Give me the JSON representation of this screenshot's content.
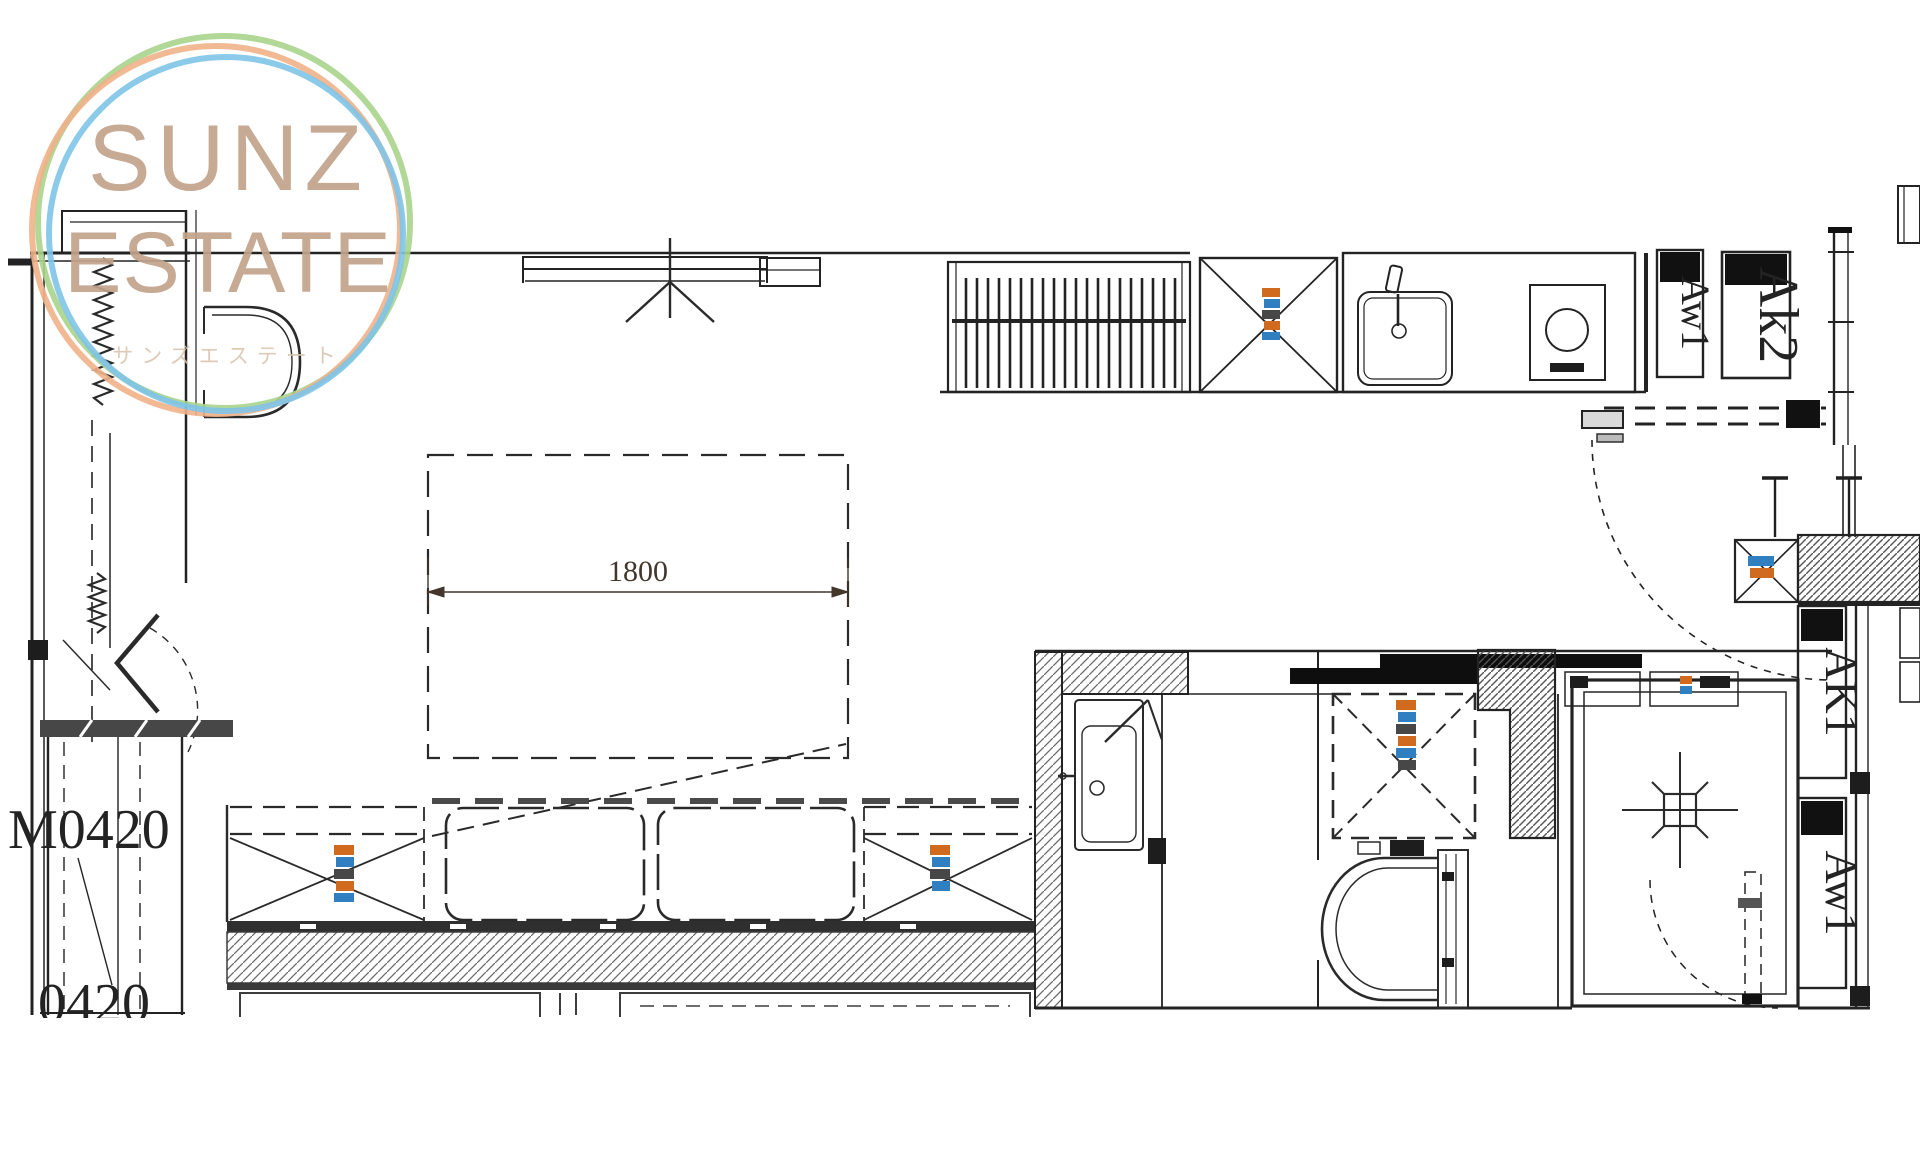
{
  "logo": {
    "line1": "SUNZ",
    "line2": "ESTATE",
    "subtitle": "サンズエステート",
    "ring_orange": "#efb188",
    "ring_green": "#a8d48c",
    "ring_blue": "#7fc4e8",
    "text_color": "#c2a38b"
  },
  "plan": {
    "labels": {
      "window_top_1": "Aw1",
      "window_top_2": "Ak2",
      "window_right_1": "AK1",
      "window_right_2": "Aw1",
      "door_left": "M0420",
      "door_left_partial": "0420",
      "bed_dimension": "1800"
    },
    "annotation_colors": {
      "orange": "#cf6a1f",
      "blue": "#2f7fc1",
      "dark": "#474747"
    },
    "line_color": "#232323"
  }
}
